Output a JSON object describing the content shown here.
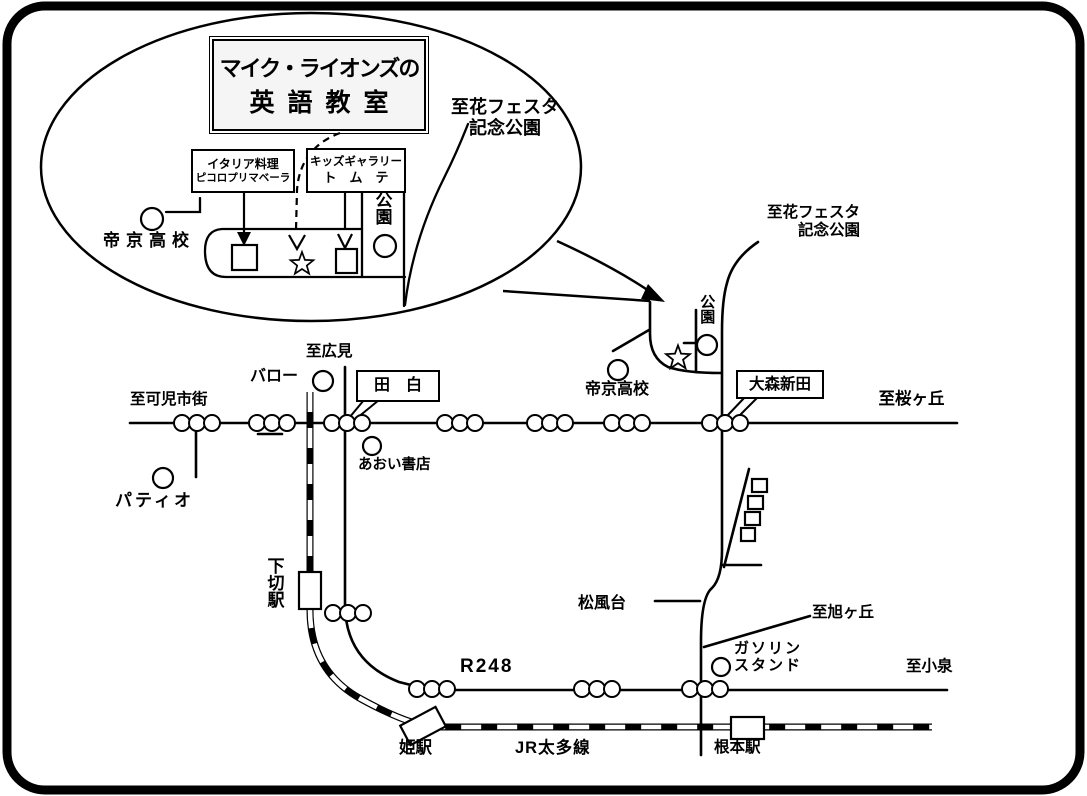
{
  "colors": {
    "ink": "#000000",
    "paper": "#ffffff"
  },
  "balloon": {
    "title_line1": "マイク・ライオンズの",
    "title_line2": "英語教室",
    "restaurant_box": {
      "line1": "イタリア料理",
      "line2": "ピコロプリマベーラ"
    },
    "gallery_box": {
      "line1": "キッズギャラリー",
      "line2": "ト　ム　テ"
    },
    "park_label": "公園",
    "school_label": "帝京高校",
    "hanafesta_line1": "至花フェスタ",
    "hanafesta_line2": "記念公園"
  },
  "map": {
    "hanafesta_line1": "至花フェスタ",
    "hanafesta_line2": "記念公園",
    "park_label": "公園",
    "school_label": "帝京高校",
    "intersection_omori": "大森新田",
    "intersection_tajiro": "田　白",
    "to_sakuragaoka": "至桜ヶ丘",
    "to_kani": "至可児市街",
    "to_hiromi": "至広見",
    "to_asahigaoka": "至旭ヶ丘",
    "to_koizumi": "至小泉",
    "store_valor": "バロー",
    "store_aoi": "あおい書店",
    "store_patio": "パティオ",
    "area_matsukazedai": "松風台",
    "gas_station_line1": "ガソリン",
    "gas_station_line2": "スタンド",
    "route_r248": "R248",
    "rail_line": "JR太多線",
    "station_shimogiri": "下切駅",
    "station_hime": "姫駅",
    "station_nemoto": "根本駅"
  }
}
